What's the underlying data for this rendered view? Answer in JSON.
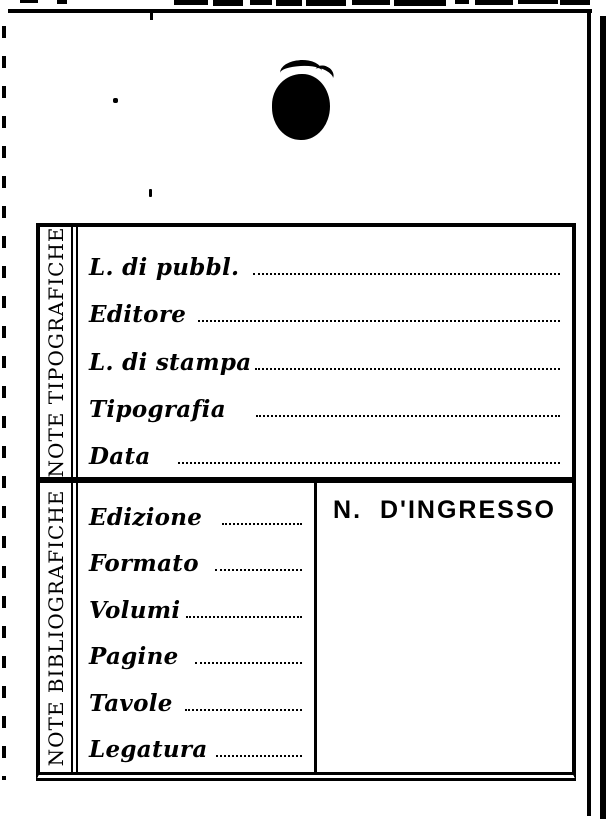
{
  "colors": {
    "ink": "#000000",
    "paper": "#ffffff"
  },
  "card": {
    "sections": [
      {
        "side_label": "NOTE TIPOGRAFICHE",
        "fields": [
          {
            "label": "L. di pubbl.",
            "value": ""
          },
          {
            "label": "Editore",
            "value": ""
          },
          {
            "label": "L. di stampa",
            "value": ""
          },
          {
            "label": "Tipografia",
            "value": ""
          },
          {
            "label": "Data",
            "value": ""
          }
        ]
      },
      {
        "side_label": "NOTE BIBLIOGRAFICHE",
        "fields": [
          {
            "label": "Edizione",
            "value": ""
          },
          {
            "label": "Formato",
            "value": ""
          },
          {
            "label": "Volumi",
            "value": ""
          },
          {
            "label": "Pagine",
            "value": ""
          },
          {
            "label": "Tavole",
            "value": ""
          },
          {
            "label": "Legatura",
            "value": ""
          }
        ],
        "ingresso": {
          "label": "N. D'INGRESSO",
          "value": ""
        }
      }
    ]
  },
  "artifacts": {
    "top_fragments": [
      {
        "x": 20,
        "w": 18,
        "h": 3
      },
      {
        "x": 57,
        "w": 10,
        "h": 4
      },
      {
        "x": 174,
        "w": 34,
        "h": 5
      },
      {
        "x": 213,
        "w": 30,
        "h": 6
      },
      {
        "x": 250,
        "w": 22,
        "h": 5
      },
      {
        "x": 276,
        "w": 26,
        "h": 6
      },
      {
        "x": 306,
        "w": 40,
        "h": 6
      },
      {
        "x": 352,
        "w": 38,
        "h": 5
      },
      {
        "x": 394,
        "w": 52,
        "h": 6
      },
      {
        "x": 455,
        "w": 14,
        "h": 4
      },
      {
        "x": 475,
        "w": 38,
        "h": 5
      },
      {
        "x": 518,
        "w": 40,
        "h": 4
      },
      {
        "x": 560,
        "w": 30,
        "h": 5
      }
    ]
  }
}
